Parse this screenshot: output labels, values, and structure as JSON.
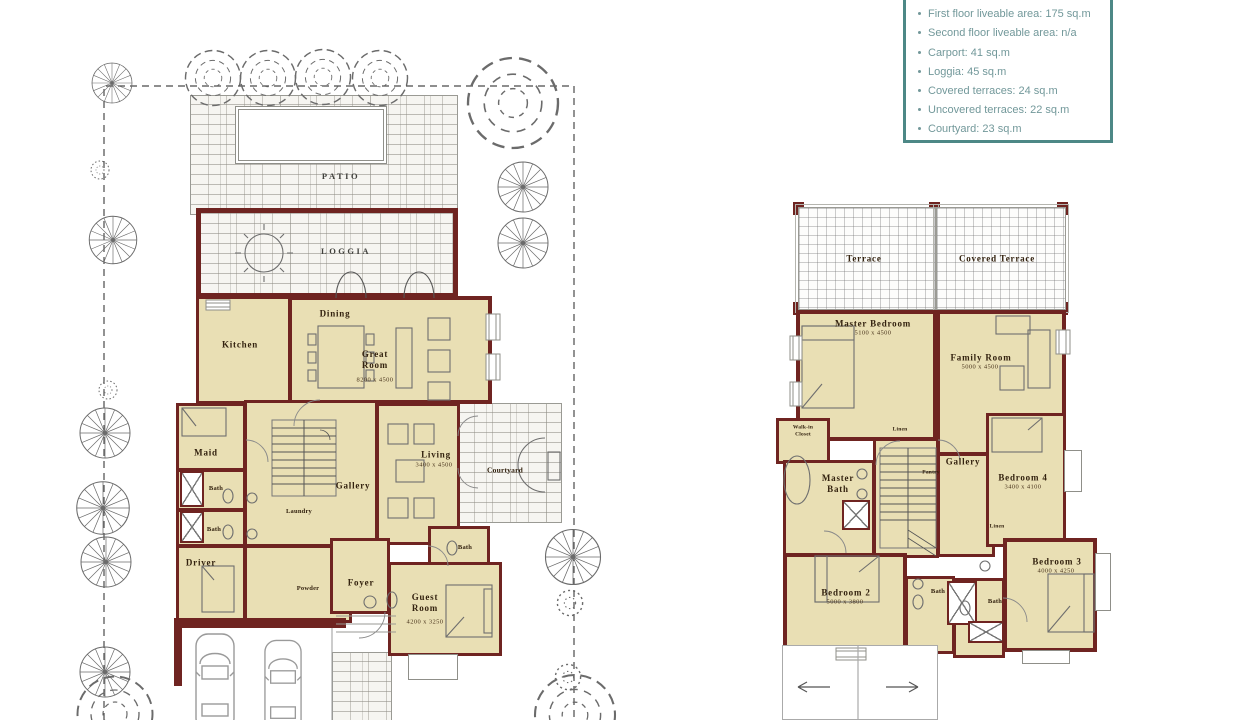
{
  "info_box": {
    "items": [
      "First floor liveable area: 175 sq.m",
      "Second floor liveable area: n/a",
      "Carport: 41 sq.m",
      "Loggia: 45 sq.m",
      "Covered terraces: 24 sq.m",
      "Uncovered terraces: 22 sq.m",
      "Courtyard: 23 sq.m"
    ],
    "border_color": "#4d8886",
    "text_color": "#72989a"
  },
  "ground_floor": {
    "patio": {
      "label": "PATIO"
    },
    "loggia": {
      "label": "LOGGIA"
    },
    "kitchen": {
      "label": "Kitchen"
    },
    "dining": {
      "label": "Dining"
    },
    "great_room": {
      "label": "Great Room",
      "dims": "8200 x 4500"
    },
    "maid": {
      "label": "Maid"
    },
    "bath_a": {
      "label": "Bath"
    },
    "bath_b": {
      "label": "Bath"
    },
    "gallery": {
      "label": "Gallery"
    },
    "laundry": {
      "label": "Laundry"
    },
    "living": {
      "label": "Living",
      "dims": "3400 x 4500"
    },
    "courtyard": {
      "label": "Courtyard"
    },
    "driver": {
      "label": "Driver"
    },
    "powder": {
      "label": "Powder"
    },
    "foyer": {
      "label": "Foyer"
    },
    "bath_c": {
      "label": "Bath"
    },
    "guest_room": {
      "label": "Guest Room",
      "dims": "4200 x 3250"
    }
  },
  "first_floor": {
    "terrace": {
      "label": "Terrace"
    },
    "covered_terrace": {
      "label": "Covered Terrace"
    },
    "master_bedroom": {
      "label": "Master Bedroom",
      "dims": "5100 x 4500"
    },
    "family_room": {
      "label": "Family Room",
      "dims": "5000 x 4500"
    },
    "walk_in_closet": {
      "label": "Walk-in Closet"
    },
    "master_bath": {
      "label": "Master Bath"
    },
    "linen_a": {
      "label": "Linen"
    },
    "pantry": {
      "label": "Pantry"
    },
    "gallery": {
      "label": "Gallery"
    },
    "bedroom4": {
      "label": "Bedroom 4",
      "dims": "3400 x 4100"
    },
    "bedroom2": {
      "label": "Bedroom 2",
      "dims": "5000 x 3800"
    },
    "bath_a": {
      "label": "Bath"
    },
    "bath_b": {
      "label": "Bath"
    },
    "linen_b": {
      "label": "Linen"
    },
    "bedroom3": {
      "label": "Bedroom 3",
      "dims": "4000 x 4250"
    }
  },
  "colors": {
    "wall": "#6f2421",
    "floor": "#e9dfb4",
    "stone_line": "#8c8a82",
    "tree_line": "#6b6b6b"
  }
}
